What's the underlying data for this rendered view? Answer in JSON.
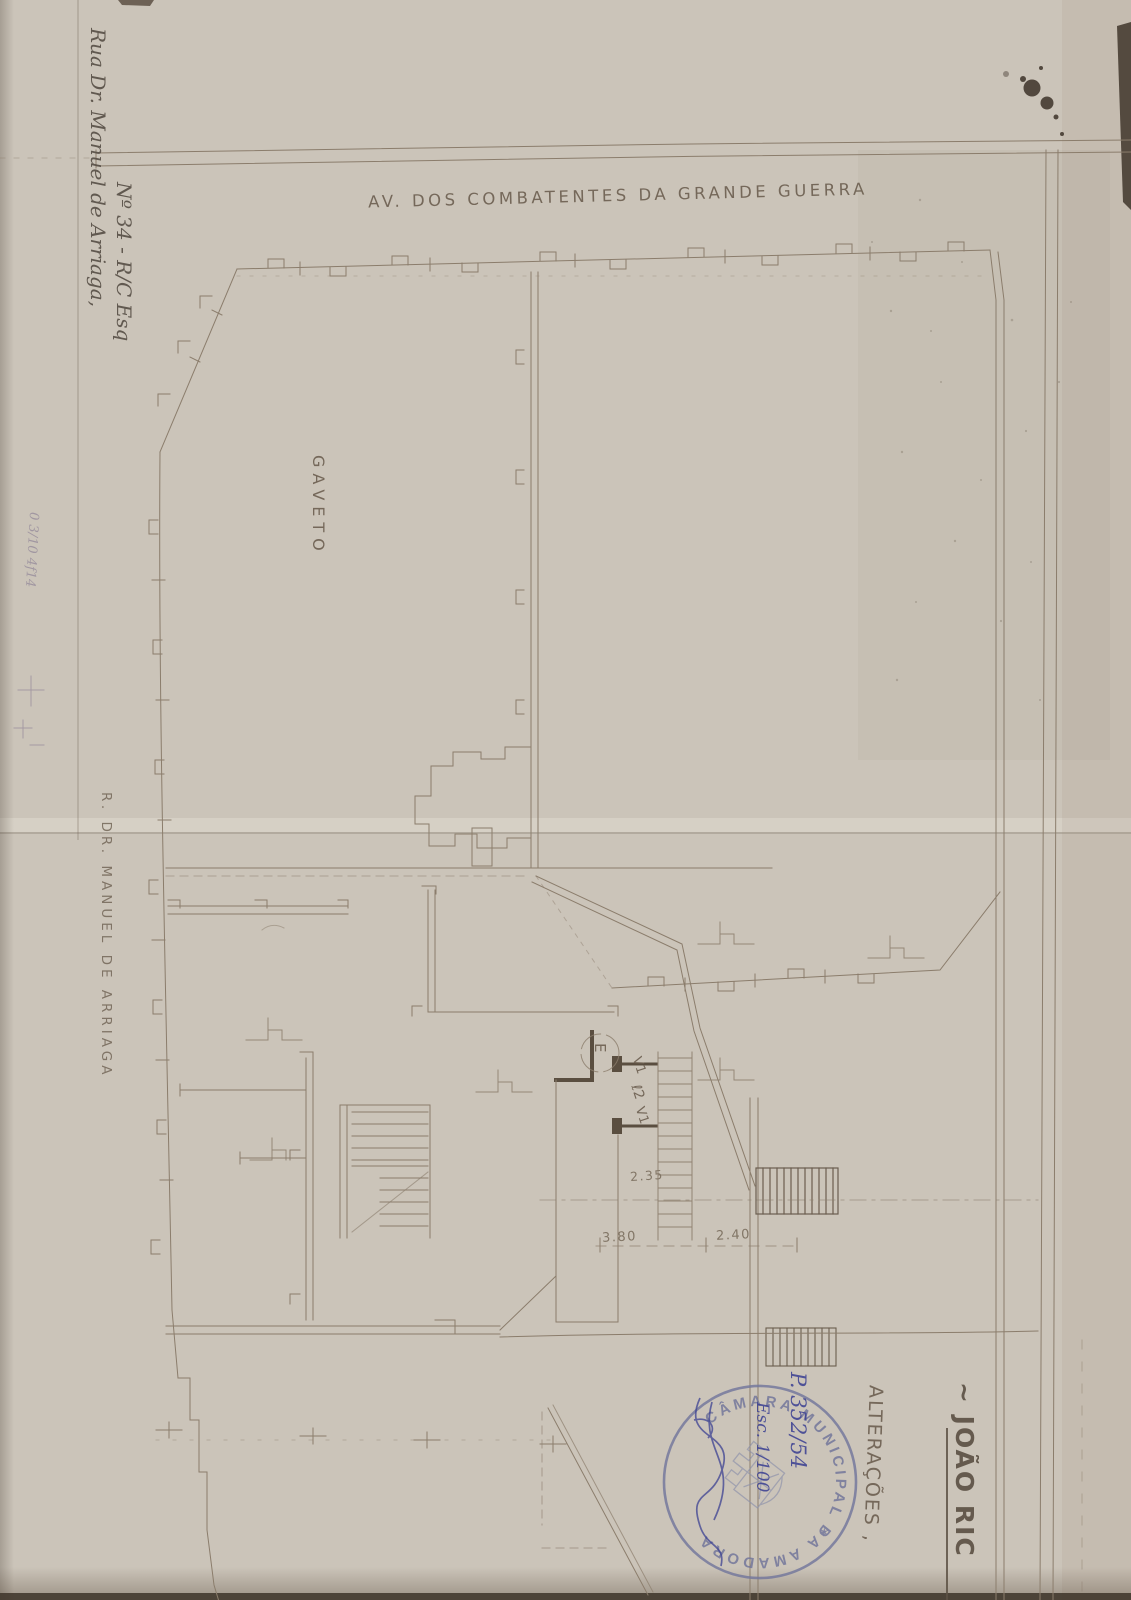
{
  "paper": {
    "background": "#cbc4b9",
    "line_color": "#8b7d6c",
    "heavy_line_color": "#5a4e40",
    "pencil_color": "#94899a",
    "ink_blue": "#3d4293",
    "stamp_blue": "#73779c"
  },
  "street_labels": {
    "avenue": "AV. DOS COMBATENTES DA GRANDE GUERRA",
    "corner": "GAVETO",
    "side_street": "R. DR. MANUEL DE ARRIAGA"
  },
  "handwritten_notes": {
    "address_line1": "Rua Dr. Manuel de Arriaga,",
    "address_line2": "Nº 34 - R/C Esq",
    "pencil_note": "0 3/10 4f14",
    "process_number": "P. 352/54",
    "scale_note": "Esc. 1/100"
  },
  "title_block": {
    "project_title": "~ JOÃO RIC",
    "subtitle": "ALTERAÇÕES ,"
  },
  "plan_annotations": {
    "entry_label": "E",
    "door_labels": [
      "V1",
      "ℓ2",
      "V1"
    ],
    "dimensions": [
      "2.35",
      "3.80",
      "2.40"
    ]
  },
  "stamp": {
    "text": "CÂMARA MUNICIPAL DA AMADORA",
    "separator": "✶"
  }
}
